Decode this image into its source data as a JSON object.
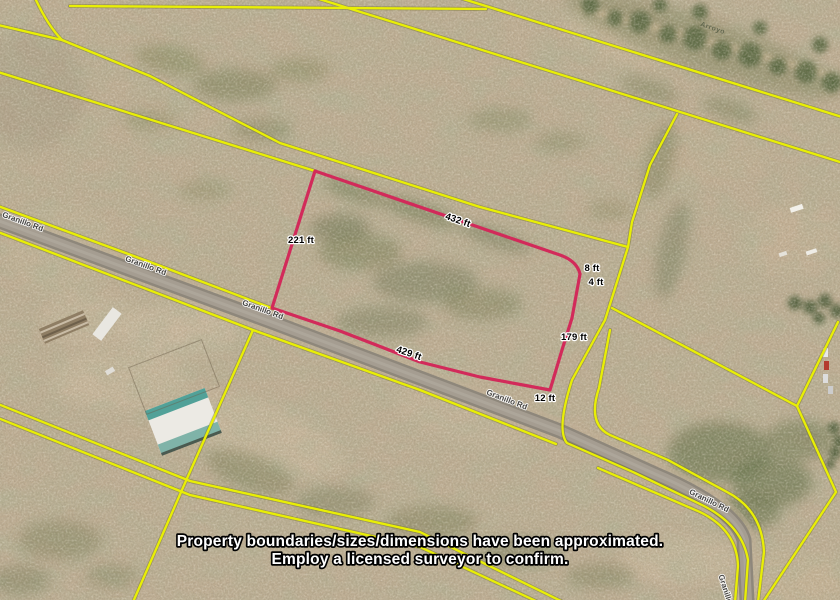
{
  "map": {
    "road_name": "Granillo Rd",
    "wash_label": "Arroyo",
    "colors": {
      "parcel_line": "#e9ef04",
      "boundary": "#d22a5a",
      "road": "#8e877b"
    }
  },
  "property": {
    "dimensions": {
      "top": "432 ft",
      "left": "221 ft",
      "bottom": "429 ft",
      "right": "179 ft",
      "jog_a": "8 ft",
      "jog_b": "4 ft",
      "jog_c": "12 ft"
    }
  },
  "disclaimer": {
    "line1": "Property boundaries/sizes/dimensions have been approximated.",
    "line2": "Employ a licensed surveyor to confirm."
  }
}
